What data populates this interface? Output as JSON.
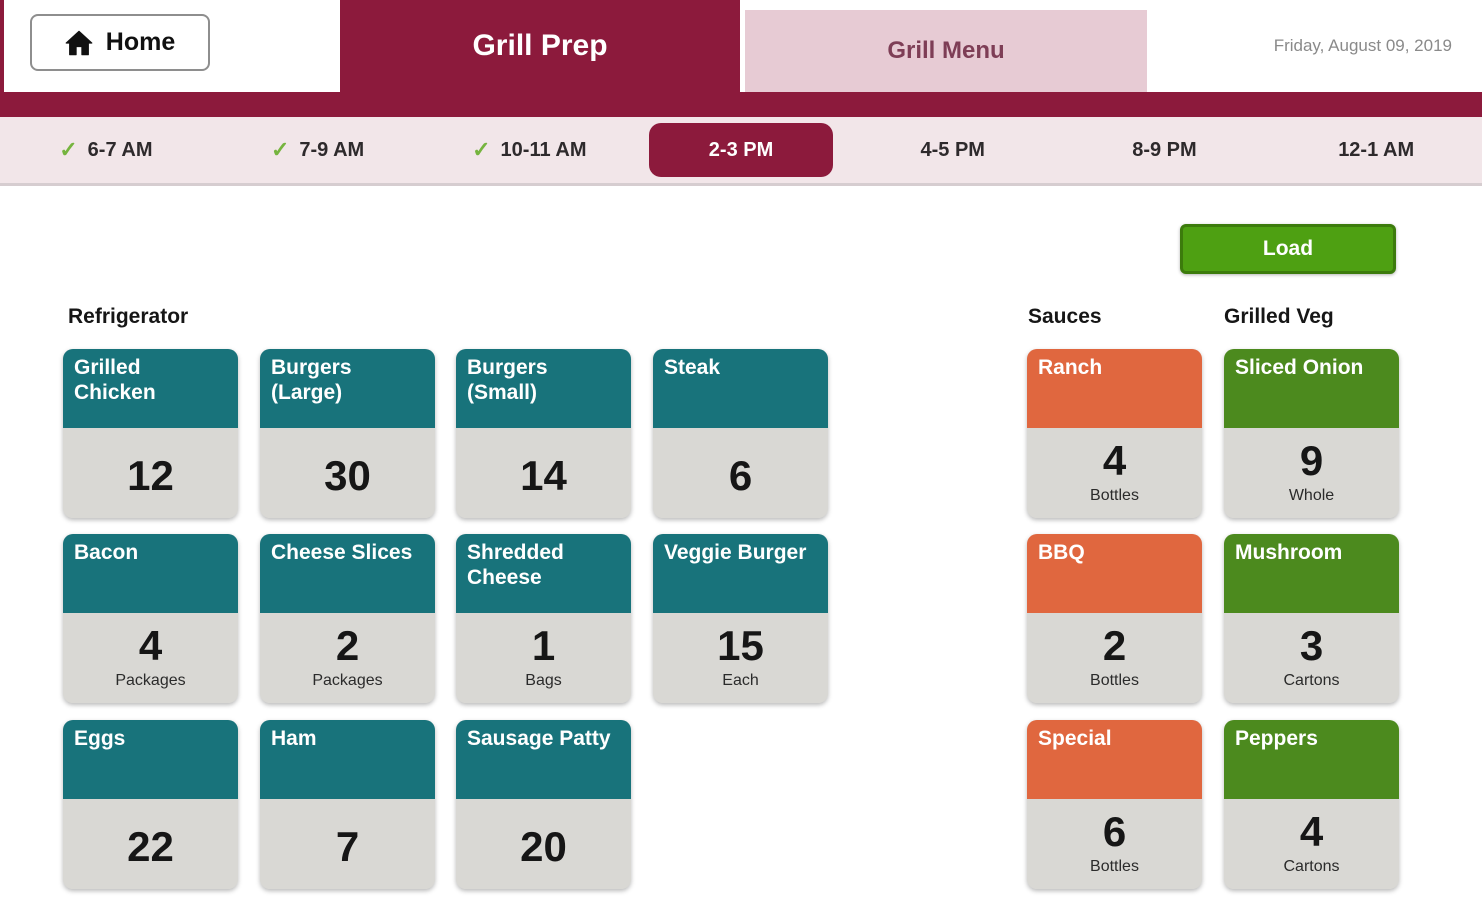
{
  "header": {
    "home": "Home",
    "tab_grill_prep": "Grill Prep",
    "tab_grill_menu": "Grill Menu",
    "date": "Friday, August 09, 2019"
  },
  "timebar": {
    "slots": [
      {
        "label": "6-7 AM",
        "checked": true,
        "active": false
      },
      {
        "label": "7-9 AM",
        "checked": true,
        "active": false
      },
      {
        "label": "10-11 AM",
        "checked": true,
        "active": false
      },
      {
        "label": "2-3 PM",
        "checked": false,
        "active": true
      },
      {
        "label": "4-5 PM",
        "checked": false,
        "active": false
      },
      {
        "label": "8-9 PM",
        "checked": false,
        "active": false
      },
      {
        "label": "12-1 AM",
        "checked": false,
        "active": false
      }
    ]
  },
  "load_button": "Load",
  "colors": {
    "maroon": "#8C1A3C",
    "pink_tab": "#E7CBD4",
    "timebar_bg": "#F2E6E9",
    "teal": "#18737B",
    "orange": "#E0673F",
    "green": "#4C8A1E",
    "load_green": "#4EA012",
    "card_body_gray": "#D9D8D4",
    "check_green": "#76B43F"
  },
  "sections": [
    {
      "title": "Refrigerator",
      "header_color": "#18737B",
      "cards": [
        {
          "title": "Grilled Chicken",
          "count": "12",
          "unit": ""
        },
        {
          "title": "Burgers (Large)",
          "count": "30",
          "unit": ""
        },
        {
          "title": "Burgers (Small)",
          "count": "14",
          "unit": ""
        },
        {
          "title": "Steak",
          "count": "6",
          "unit": ""
        },
        {
          "title": "Bacon",
          "count": "4",
          "unit": "Packages"
        },
        {
          "title": "Cheese Slices",
          "count": "2",
          "unit": "Packages"
        },
        {
          "title": "Shredded Cheese",
          "count": "1",
          "unit": "Bags"
        },
        {
          "title": "Veggie Burger",
          "count": "15",
          "unit": "Each"
        },
        {
          "title": "Eggs",
          "count": "22",
          "unit": ""
        },
        {
          "title": "Ham",
          "count": "7",
          "unit": ""
        },
        {
          "title": "Sausage Patty",
          "count": "20",
          "unit": ""
        }
      ]
    },
    {
      "title": "Sauces",
      "header_color": "#E0673F",
      "cards": [
        {
          "title": "Ranch",
          "count": "4",
          "unit": "Bottles"
        },
        {
          "title": "BBQ",
          "count": "2",
          "unit": "Bottles"
        },
        {
          "title": "Special",
          "count": "6",
          "unit": "Bottles"
        }
      ]
    },
    {
      "title": "Grilled Veg",
      "header_color": "#4C8A1E",
      "cards": [
        {
          "title": "Sliced Onion",
          "count": "9",
          "unit": "Whole"
        },
        {
          "title": "Mushroom",
          "count": "3",
          "unit": "Cartons"
        },
        {
          "title": "Peppers",
          "count": "4",
          "unit": "Cartons"
        }
      ]
    }
  ]
}
